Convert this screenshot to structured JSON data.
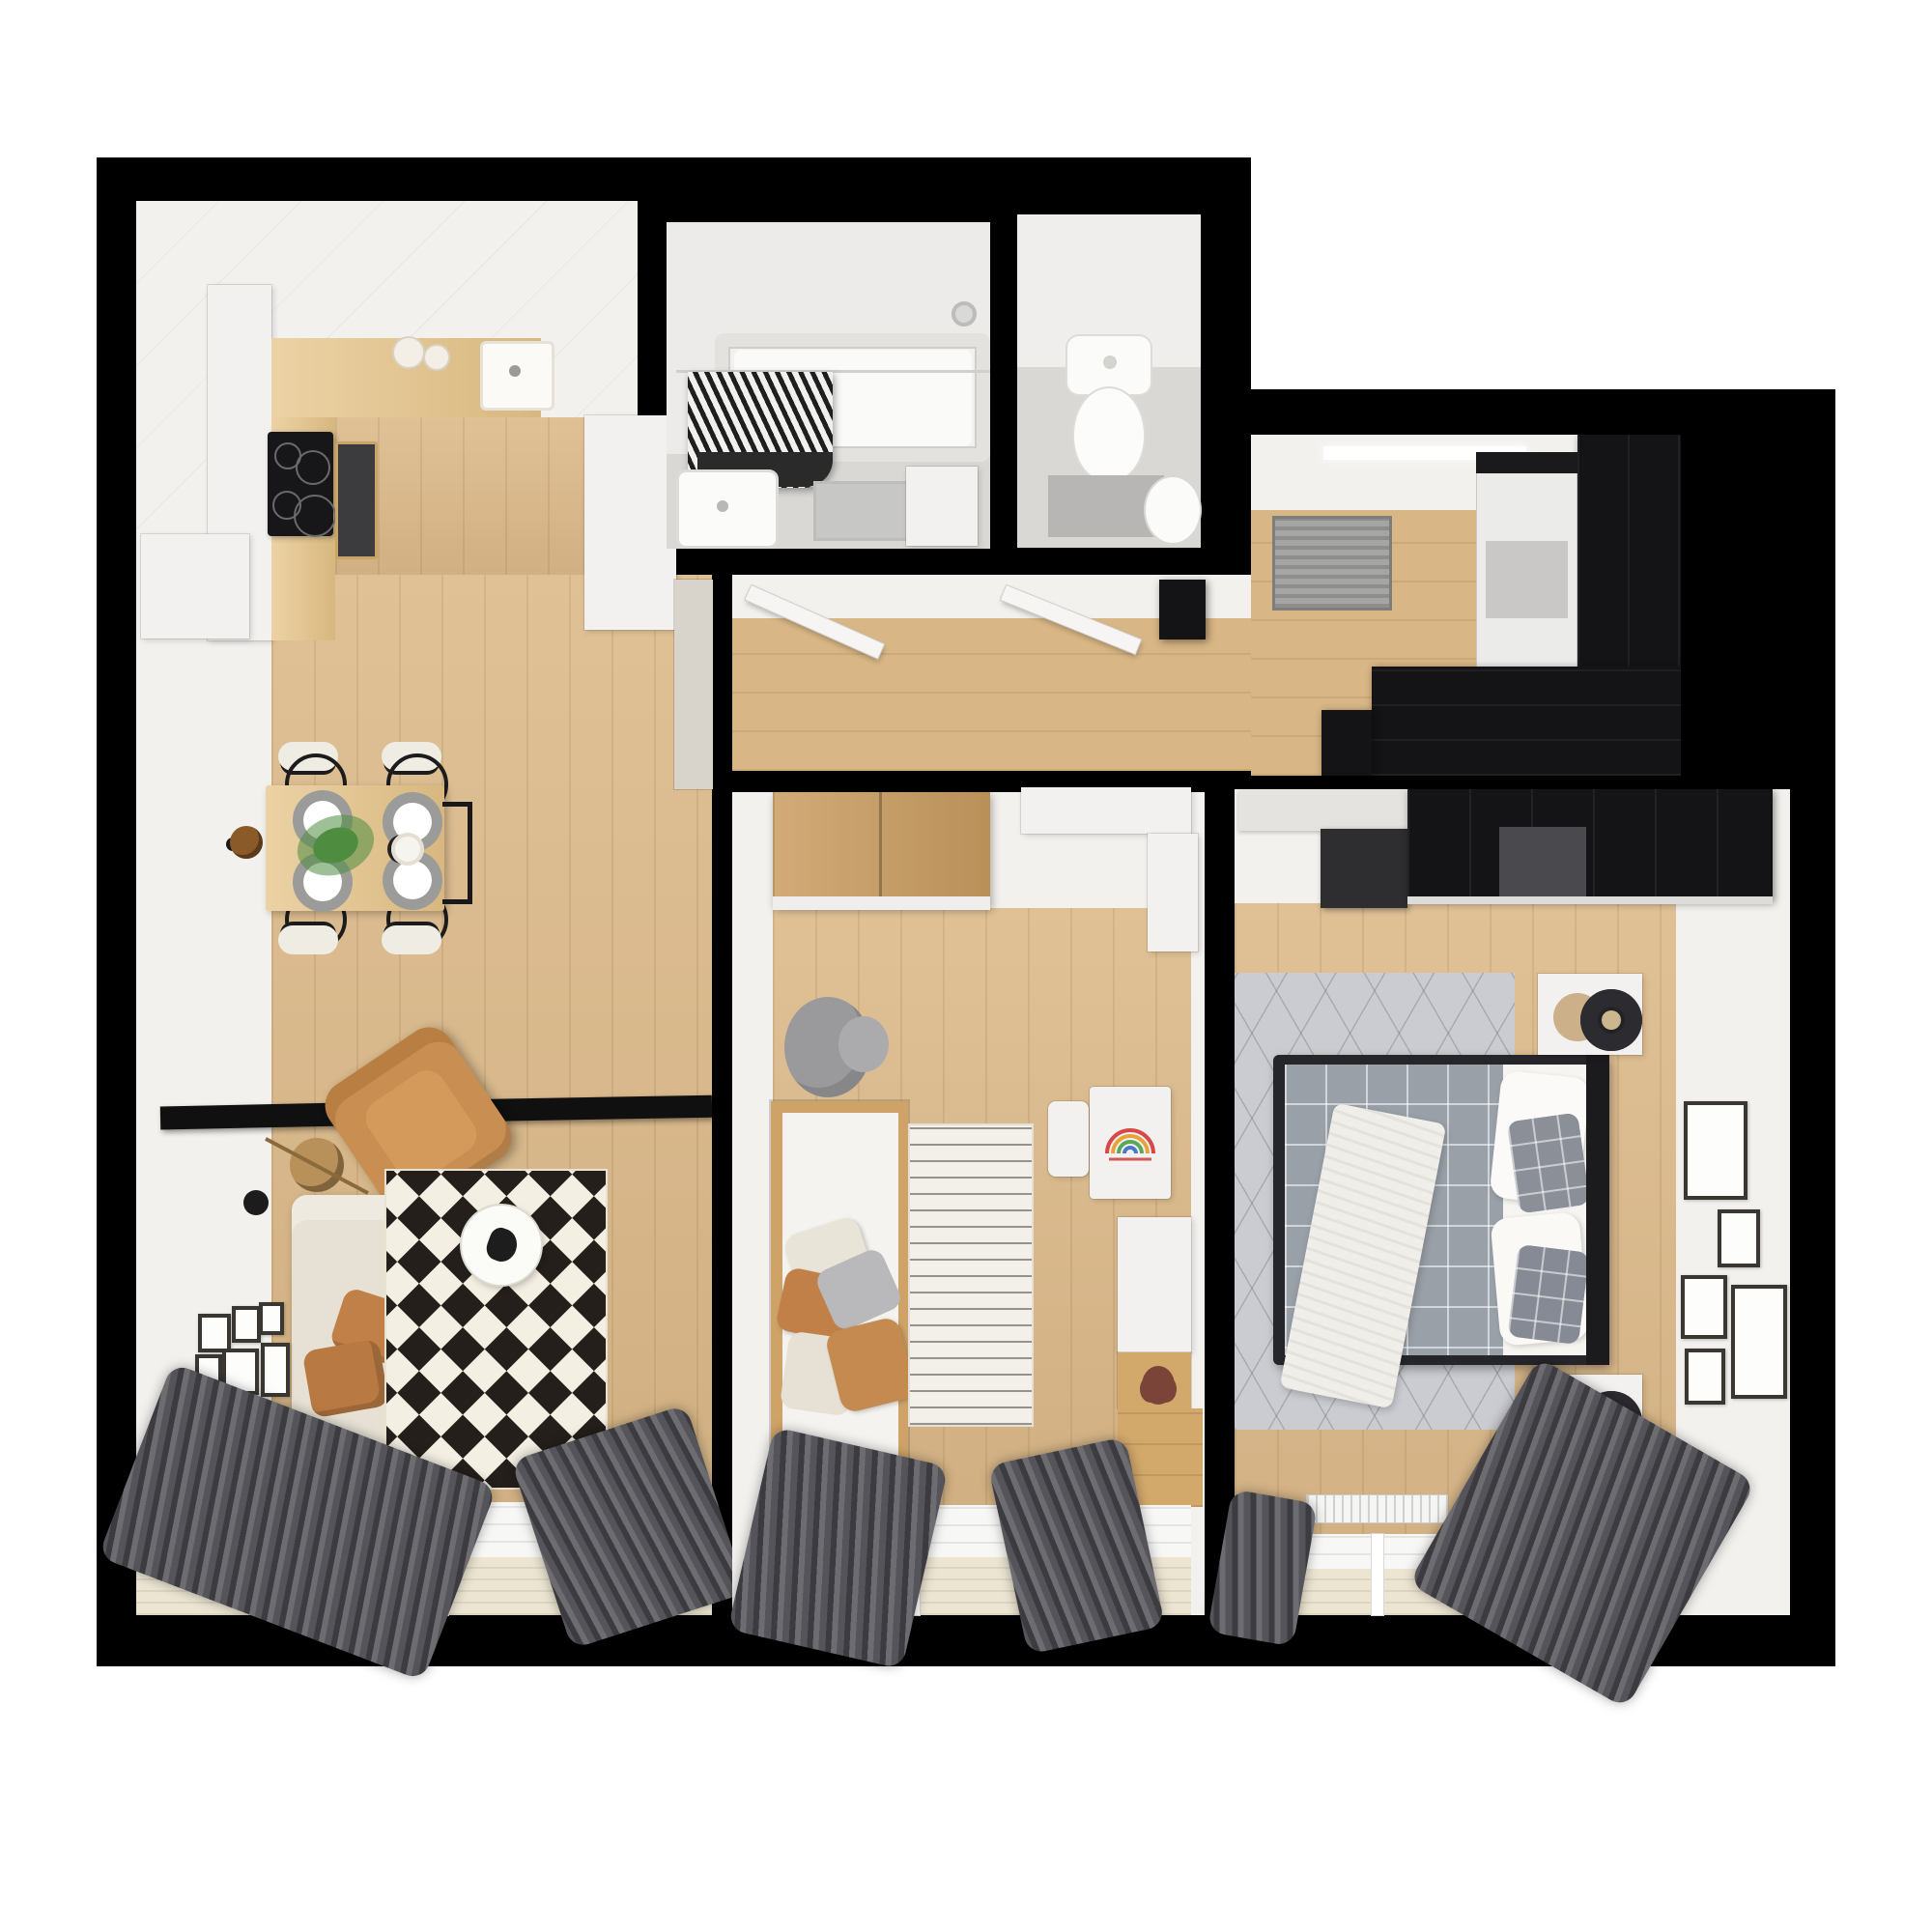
{
  "image_type": "3d-rendered-apartment-floor-plan-top-view",
  "visible_text": [],
  "colors": {
    "page_background": "#ffffff",
    "outer_wall": "#000000",
    "inner_wall_face": "#f2f1ee",
    "wood_floor": "#dcba8a",
    "kitchen_counter_wood": "#e5c387",
    "wardrobe_wood": "#c99c60",
    "black_furniture": "#141416",
    "sofa_cream": "#e6e1d4",
    "armchair_tan": "#c98f52",
    "pillow_tan": "#c08048",
    "curtain_gray": "#55545a",
    "rug_diamond_black": "#241f1b",
    "rug_diamond_cream": "#f4efe3",
    "master_rug_gray": "#cbccd1",
    "duvet_gray": "#9aa0a8",
    "bathroom_tile": "#d9d8d5",
    "balcony_floor": "#ece5d2",
    "plant_green": "#4e8c3f"
  },
  "rooms": [
    {
      "name": "kitchen-dining-living",
      "furniture": [
        "kitchen-counter",
        "sink",
        "cooktop",
        "oven",
        "tall-cabinet",
        "dining-table",
        "dining-chairs",
        "plates",
        "plant",
        "wall-lamp",
        "media-shelf",
        "armchair",
        "sofa",
        "floor-lamp",
        "coffee-table",
        "diamond-rug",
        "gallery-frames",
        "curtains",
        "balcony-window",
        "radiator"
      ]
    },
    {
      "name": "bathroom",
      "furniture": [
        "bathtub",
        "shower-curtain",
        "shower-head",
        "washbasin",
        "vanity-cabinet",
        "bath-rug"
      ]
    },
    {
      "name": "wc",
      "furniture": [
        "toilet",
        "wc-mat",
        "small-basin"
      ]
    },
    {
      "name": "hallway",
      "furniture": [
        "open-door-bathroom",
        "open-door-wc",
        "hall-cabinet"
      ]
    },
    {
      "name": "entry-room",
      "furniture": [
        "doormat",
        "black-wardrobe",
        "white-cabinet-front",
        "black-sideboard"
      ]
    },
    {
      "name": "kids-room",
      "furniture": [
        "wood-wardrobe",
        "white-console",
        "elephant-plush",
        "kids-bed",
        "pillow-pile",
        "striped-rug",
        "kids-desk",
        "kids-chair",
        "wall-unit",
        "teddy-bear",
        "curtains",
        "balcony-window"
      ]
    },
    {
      "name": "master-bedroom",
      "furniture": [
        "white-shelf",
        "black-wardrobe",
        "dark-dresser",
        "geometric-rug",
        "double-bed",
        "gray-duvet",
        "checkered-pillows",
        "white-throw",
        "headboard",
        "nightstand-lamp-1",
        "nightstand-lamp-2",
        "gallery-frames",
        "radiator",
        "curtains",
        "balcony-window"
      ]
    }
  ]
}
